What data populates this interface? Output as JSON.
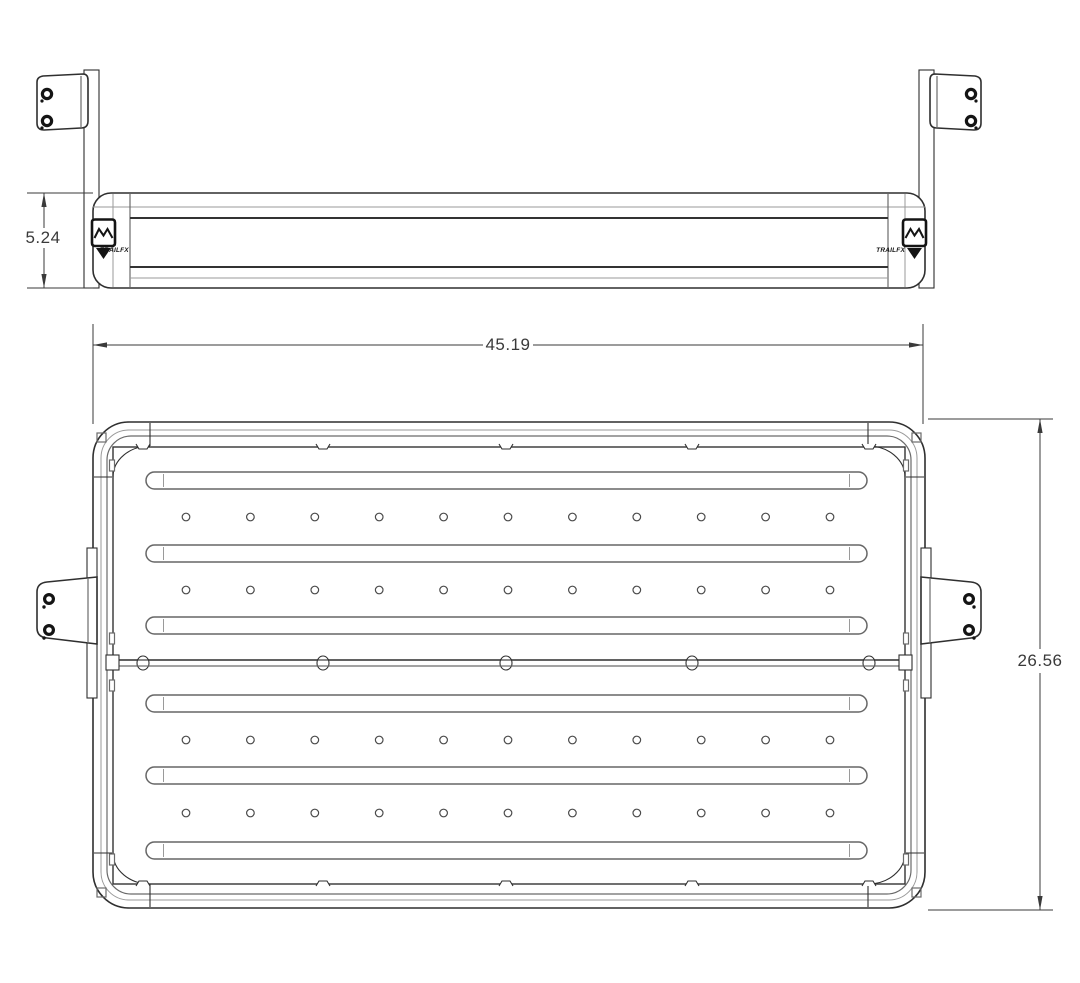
{
  "drawing": {
    "background_color": "#ffffff",
    "line_color": "#2f2f2f",
    "light_line_color": "#9a9a9a",
    "dim_text_color": "#3a3a3a"
  },
  "dimensions": {
    "side_height": "5.24",
    "plan_width": "45.19",
    "plan_depth": "26.56"
  },
  "logo": {
    "text": "TRAILFX"
  },
  "features": {
    "slot_count": 6,
    "hole_row_count": 4,
    "holes_per_row": 11,
    "seam_clip_count": 5,
    "rail_clip_count": 5,
    "bracket_count": 4
  }
}
